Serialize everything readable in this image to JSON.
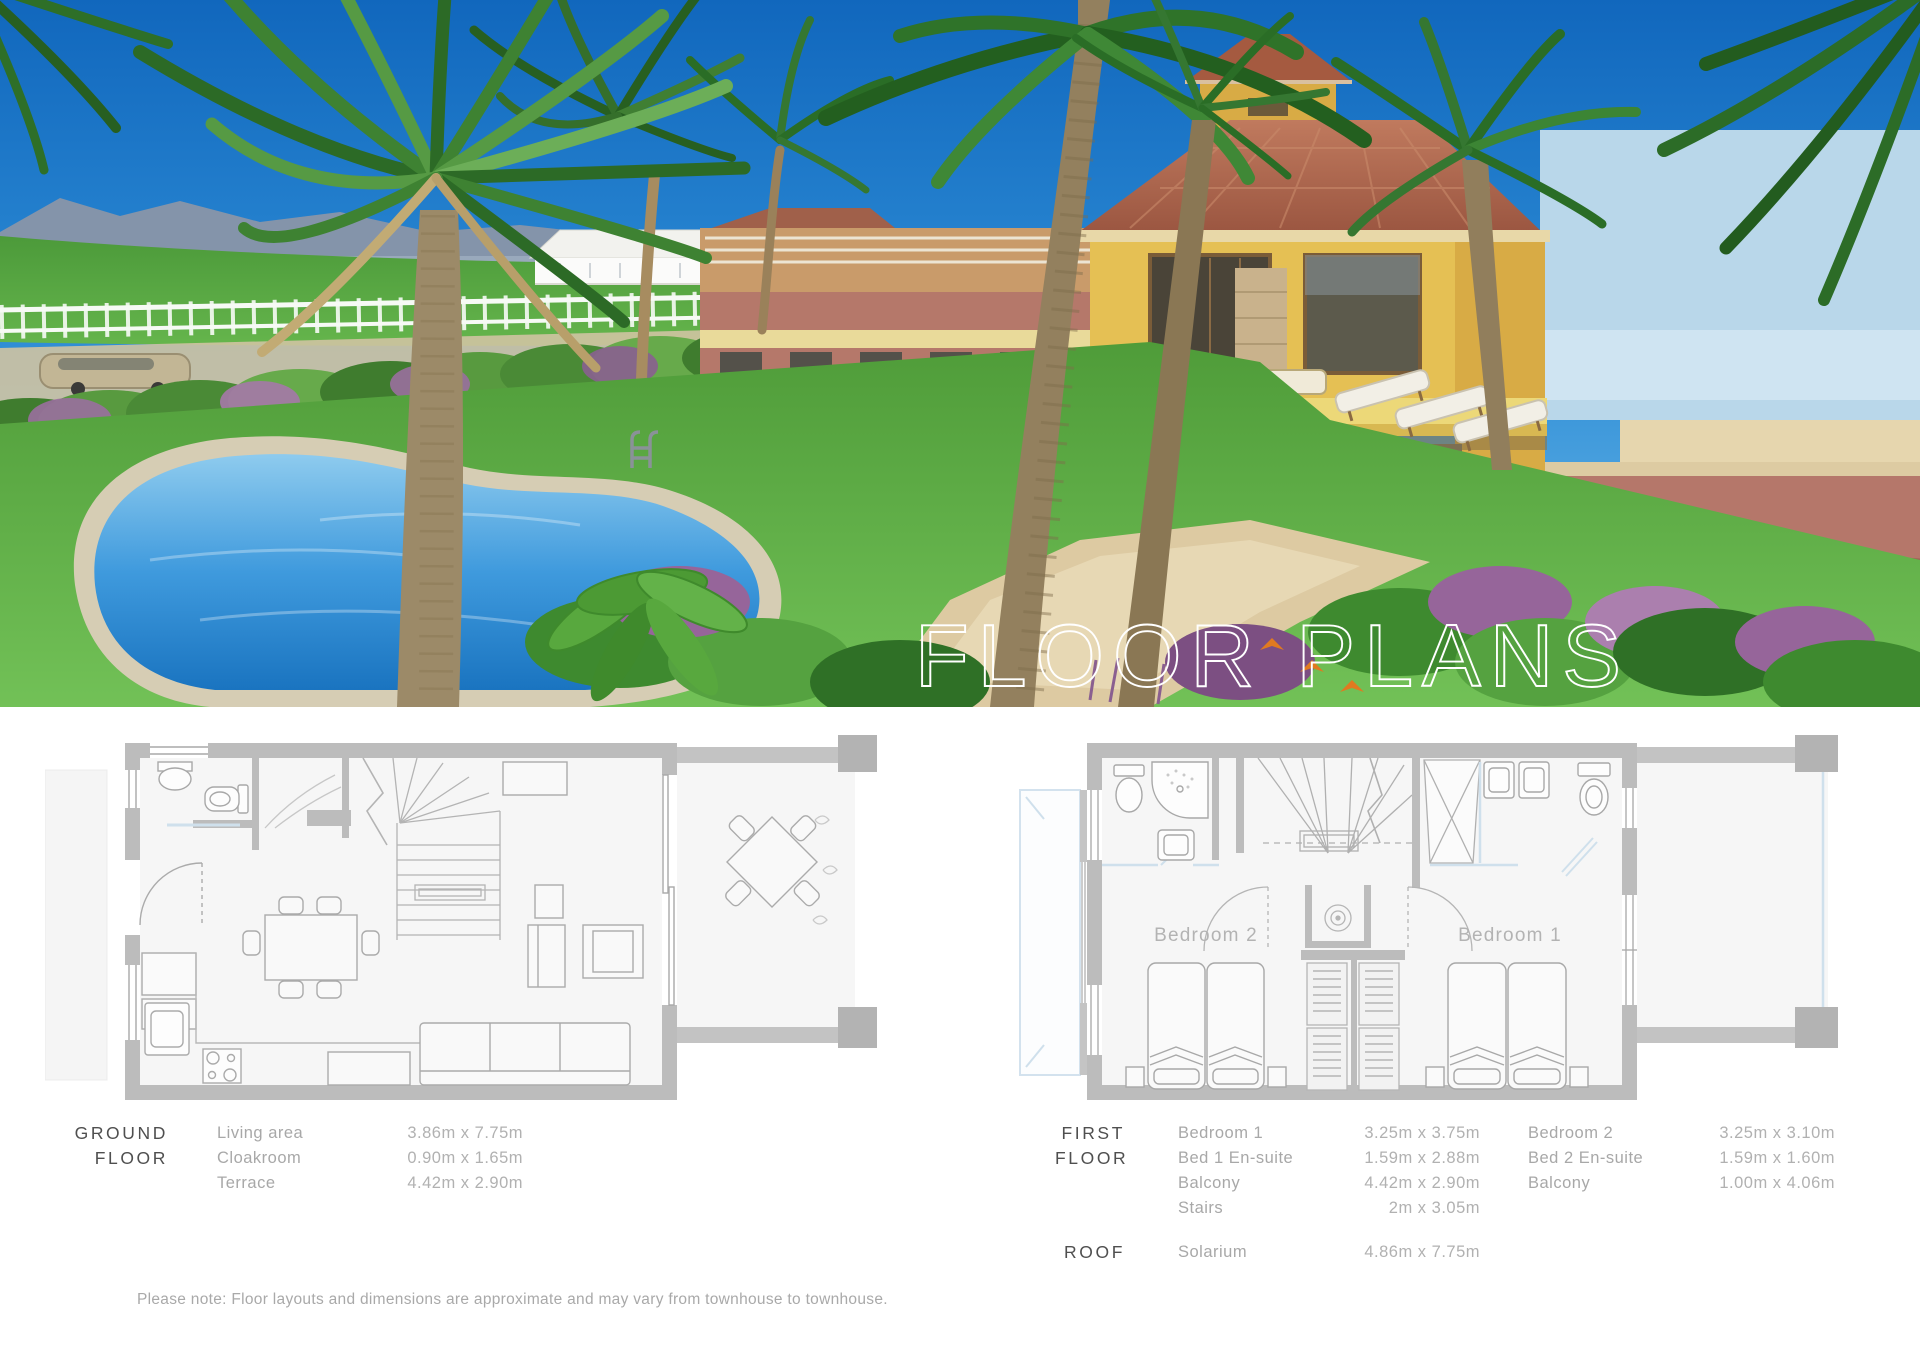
{
  "hero": {
    "title": "FLOOR PLANS"
  },
  "ground_floor": {
    "label_line1": "GROUND",
    "label_line2": "FLOOR",
    "rooms": [
      {
        "name": "Living area",
        "dims": "3.86m x 7.75m"
      },
      {
        "name": "Cloakroom",
        "dims": "0.90m x 1.65m"
      },
      {
        "name": "Terrace",
        "dims": "4.42m x 2.90m"
      }
    ]
  },
  "first_floor": {
    "label_line1": "FIRST",
    "label_line2": "FLOOR",
    "col1": [
      {
        "name": "Bedroom 1",
        "dims": "3.25m x 3.75m"
      },
      {
        "name": "Bed 1 En-suite",
        "dims": "1.59m x 2.88m"
      },
      {
        "name": "Balcony",
        "dims": "4.42m x 2.90m"
      },
      {
        "name": "Stairs",
        "dims": "2m x 3.05m"
      }
    ],
    "col2": [
      {
        "name": "Bedroom 2",
        "dims": "3.25m x 3.10m"
      },
      {
        "name": "Bed 2 En-suite",
        "dims": "1.59m x 1.60m"
      },
      {
        "name": "Balcony",
        "dims": "1.00m x 4.06m"
      }
    ],
    "plan_labels": {
      "bedroom1": "Bedroom 1",
      "bedroom2": "Bedroom 2"
    }
  },
  "roof": {
    "label": "ROOF",
    "rooms": [
      {
        "name": "Solarium",
        "dims": "4.86m x 7.75m"
      }
    ]
  },
  "note": "Please note: Floor layouts and dimensions are approximate and may vary from townhouse to townhouse.",
  "colors": {
    "heading_text": "#4f4f4f",
    "body_text": "#a8a8a8",
    "wall_gray": "#bcbcbc",
    "corner_block_gray": "#b3b3b3",
    "plan_floor": "#f6f6f6",
    "accent_blue": "#cfe0ec",
    "sky_blue": "#1b74c8",
    "pool_blue": "#2e8fd8",
    "house_yellow": "#e5c054",
    "roof_terracotta": "#a85c43",
    "lawn_green": "#5aa943"
  }
}
